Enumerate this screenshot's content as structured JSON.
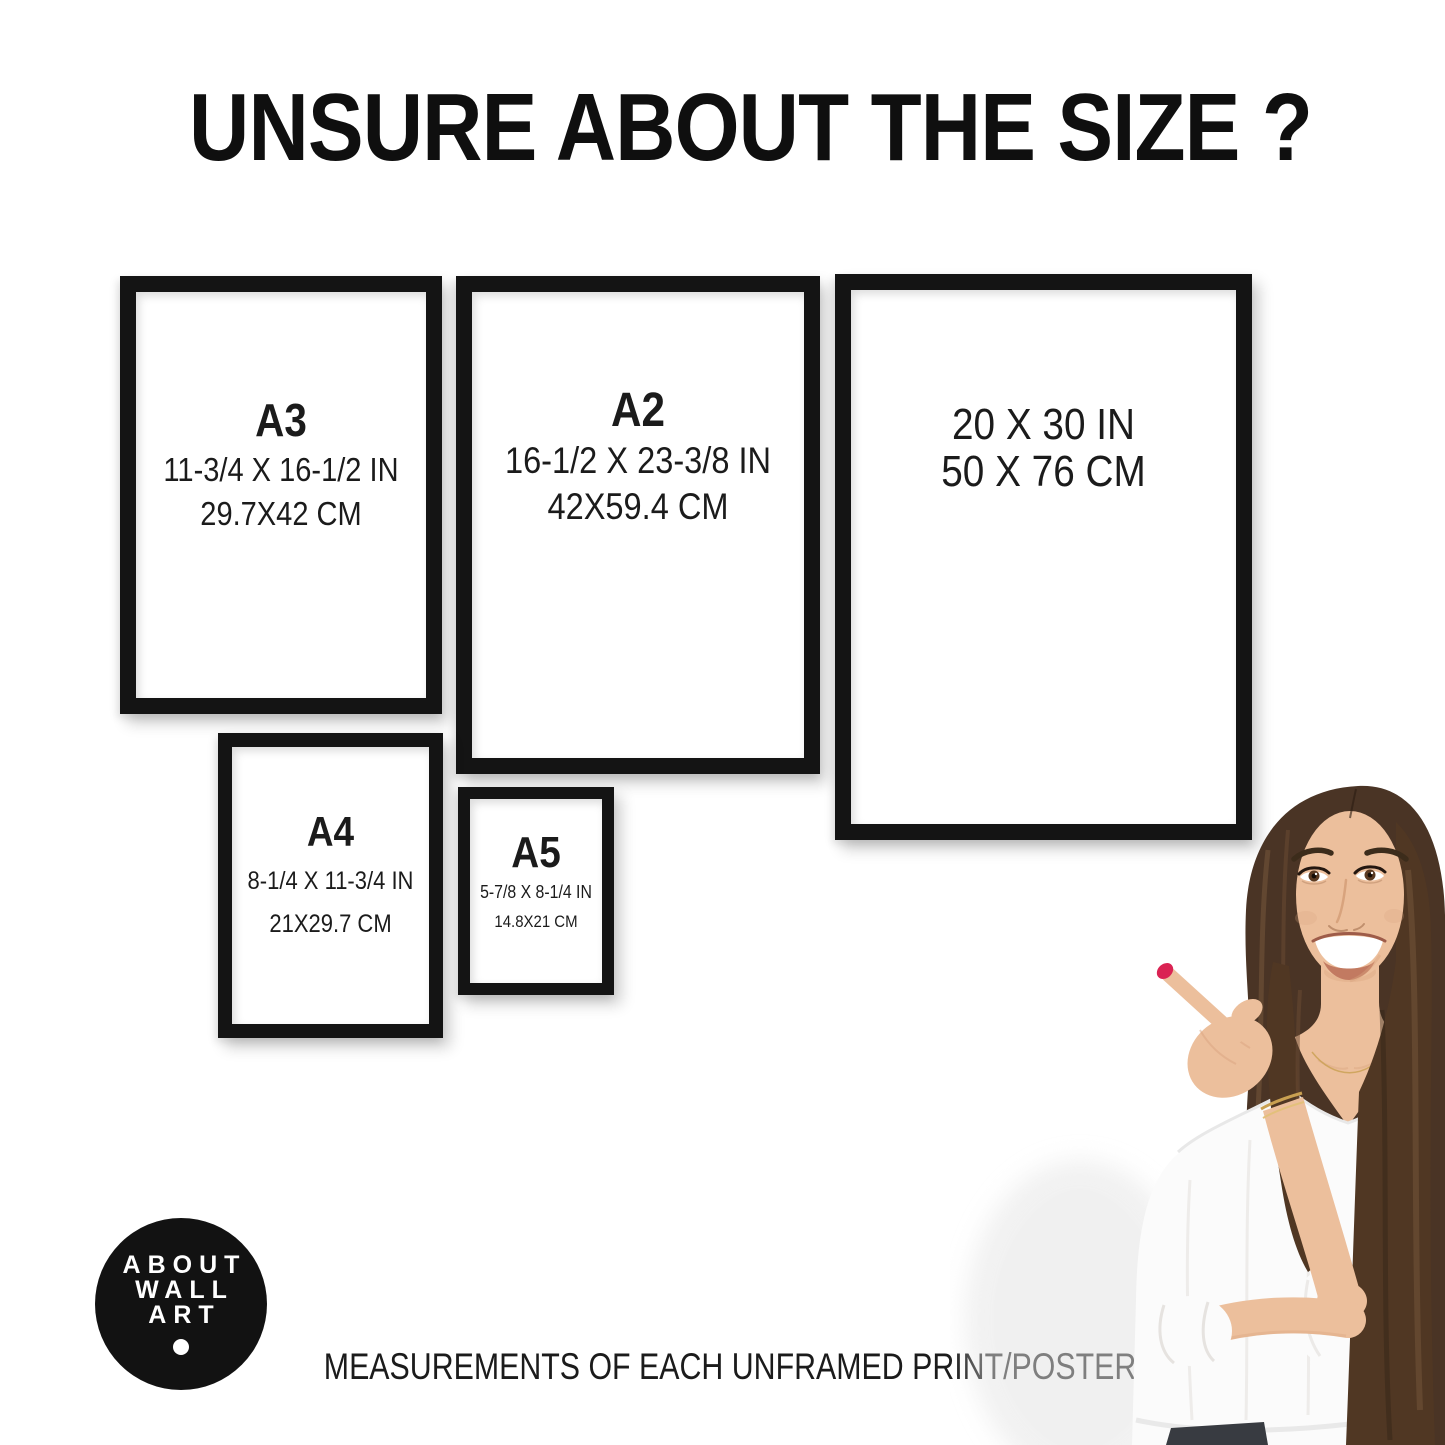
{
  "title": "UNSURE ABOUT THE SIZE ?",
  "frames": [
    {
      "label": "A3",
      "inches": "11-3/4 X 16-1/2 IN",
      "cm": "29.7X42 CM"
    },
    {
      "label": "A2",
      "inches": "16-1/2 X 23-3/8 IN",
      "cm": "42X59.4 CM"
    },
    {
      "label": "",
      "inches": "20 X 30 IN",
      "cm": "50 X 76 CM"
    },
    {
      "label": "A4",
      "inches": "8-1/4 X 11-3/4 IN",
      "cm": "21X29.7 CM"
    },
    {
      "label": "A5",
      "inches": "5-7/8 X 8-1/4 IN",
      "cm": "14.8X21 CM"
    }
  ],
  "logo": {
    "line1": "ABOUT",
    "line2": "WALL",
    "line3": "ART"
  },
  "footer": "MEASUREMENTS OF EACH UNFRAMED PRINT/POSTER",
  "colors": {
    "background": "#ffffff",
    "frame_black": "#141414",
    "text": "#1b1b1b",
    "logo_bg": "#121212",
    "logo_text": "#ffffff",
    "nail_red": "#da2353",
    "hair_brown": "#4a3425",
    "skin": "#ecbf9c",
    "blouse_white": "#fbfbfb"
  }
}
